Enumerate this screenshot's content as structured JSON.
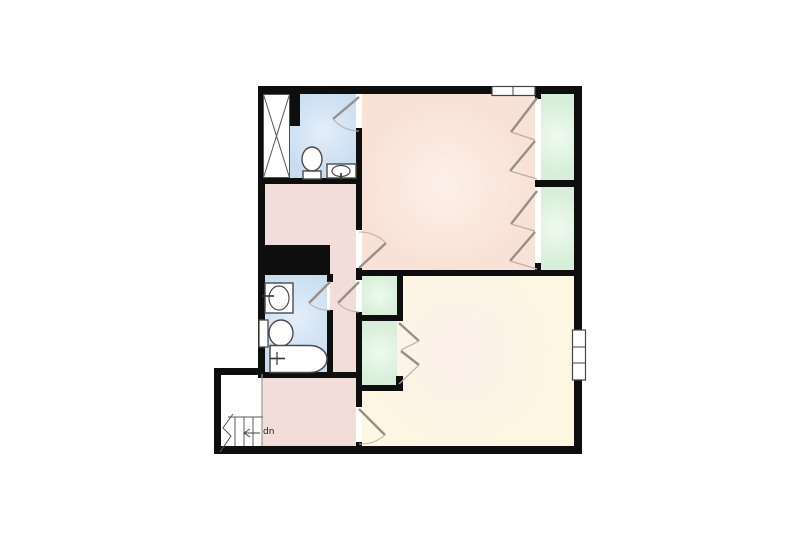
{
  "floorplan": {
    "stairs_label": "dn",
    "colors": {
      "background": "#ffffff",
      "wall": "#0e0e0e",
      "bedroom_upper": "#f8e1d6",
      "bedroom_lower": "#fcf6e2",
      "bathroom": "#c9ddf1",
      "closet": "#d7eed8",
      "hallway": "#f2ddd8",
      "door_leaf": "#998f87",
      "door_arc": "#b9afa7",
      "fixture_fill": "#ffffff",
      "fixture_line": "#4a4a4a"
    },
    "rooms": [
      {
        "id": "bedroom-upper",
        "type": "bedroom",
        "features": [
          "two-bifold-closets",
          "top-window",
          "ensuite-bathroom-door",
          "hall-door"
        ]
      },
      {
        "id": "bathroom-upper",
        "type": "bathroom",
        "features": [
          "shower-x-stall",
          "toilet",
          "sink-vanity"
        ]
      },
      {
        "id": "bedroom-lower",
        "type": "bedroom",
        "features": [
          "bifold-closet",
          "right-window",
          "hall-door"
        ]
      },
      {
        "id": "bathroom-lower",
        "type": "bathroom",
        "features": [
          "sink-vanity",
          "toilet",
          "bathtub"
        ]
      },
      {
        "id": "hallway",
        "type": "hallway",
        "features": [
          "linen-closet",
          "chimney-chase"
        ]
      },
      {
        "id": "stairs",
        "type": "stairwell",
        "label": "dn",
        "direction": "down"
      }
    ]
  }
}
